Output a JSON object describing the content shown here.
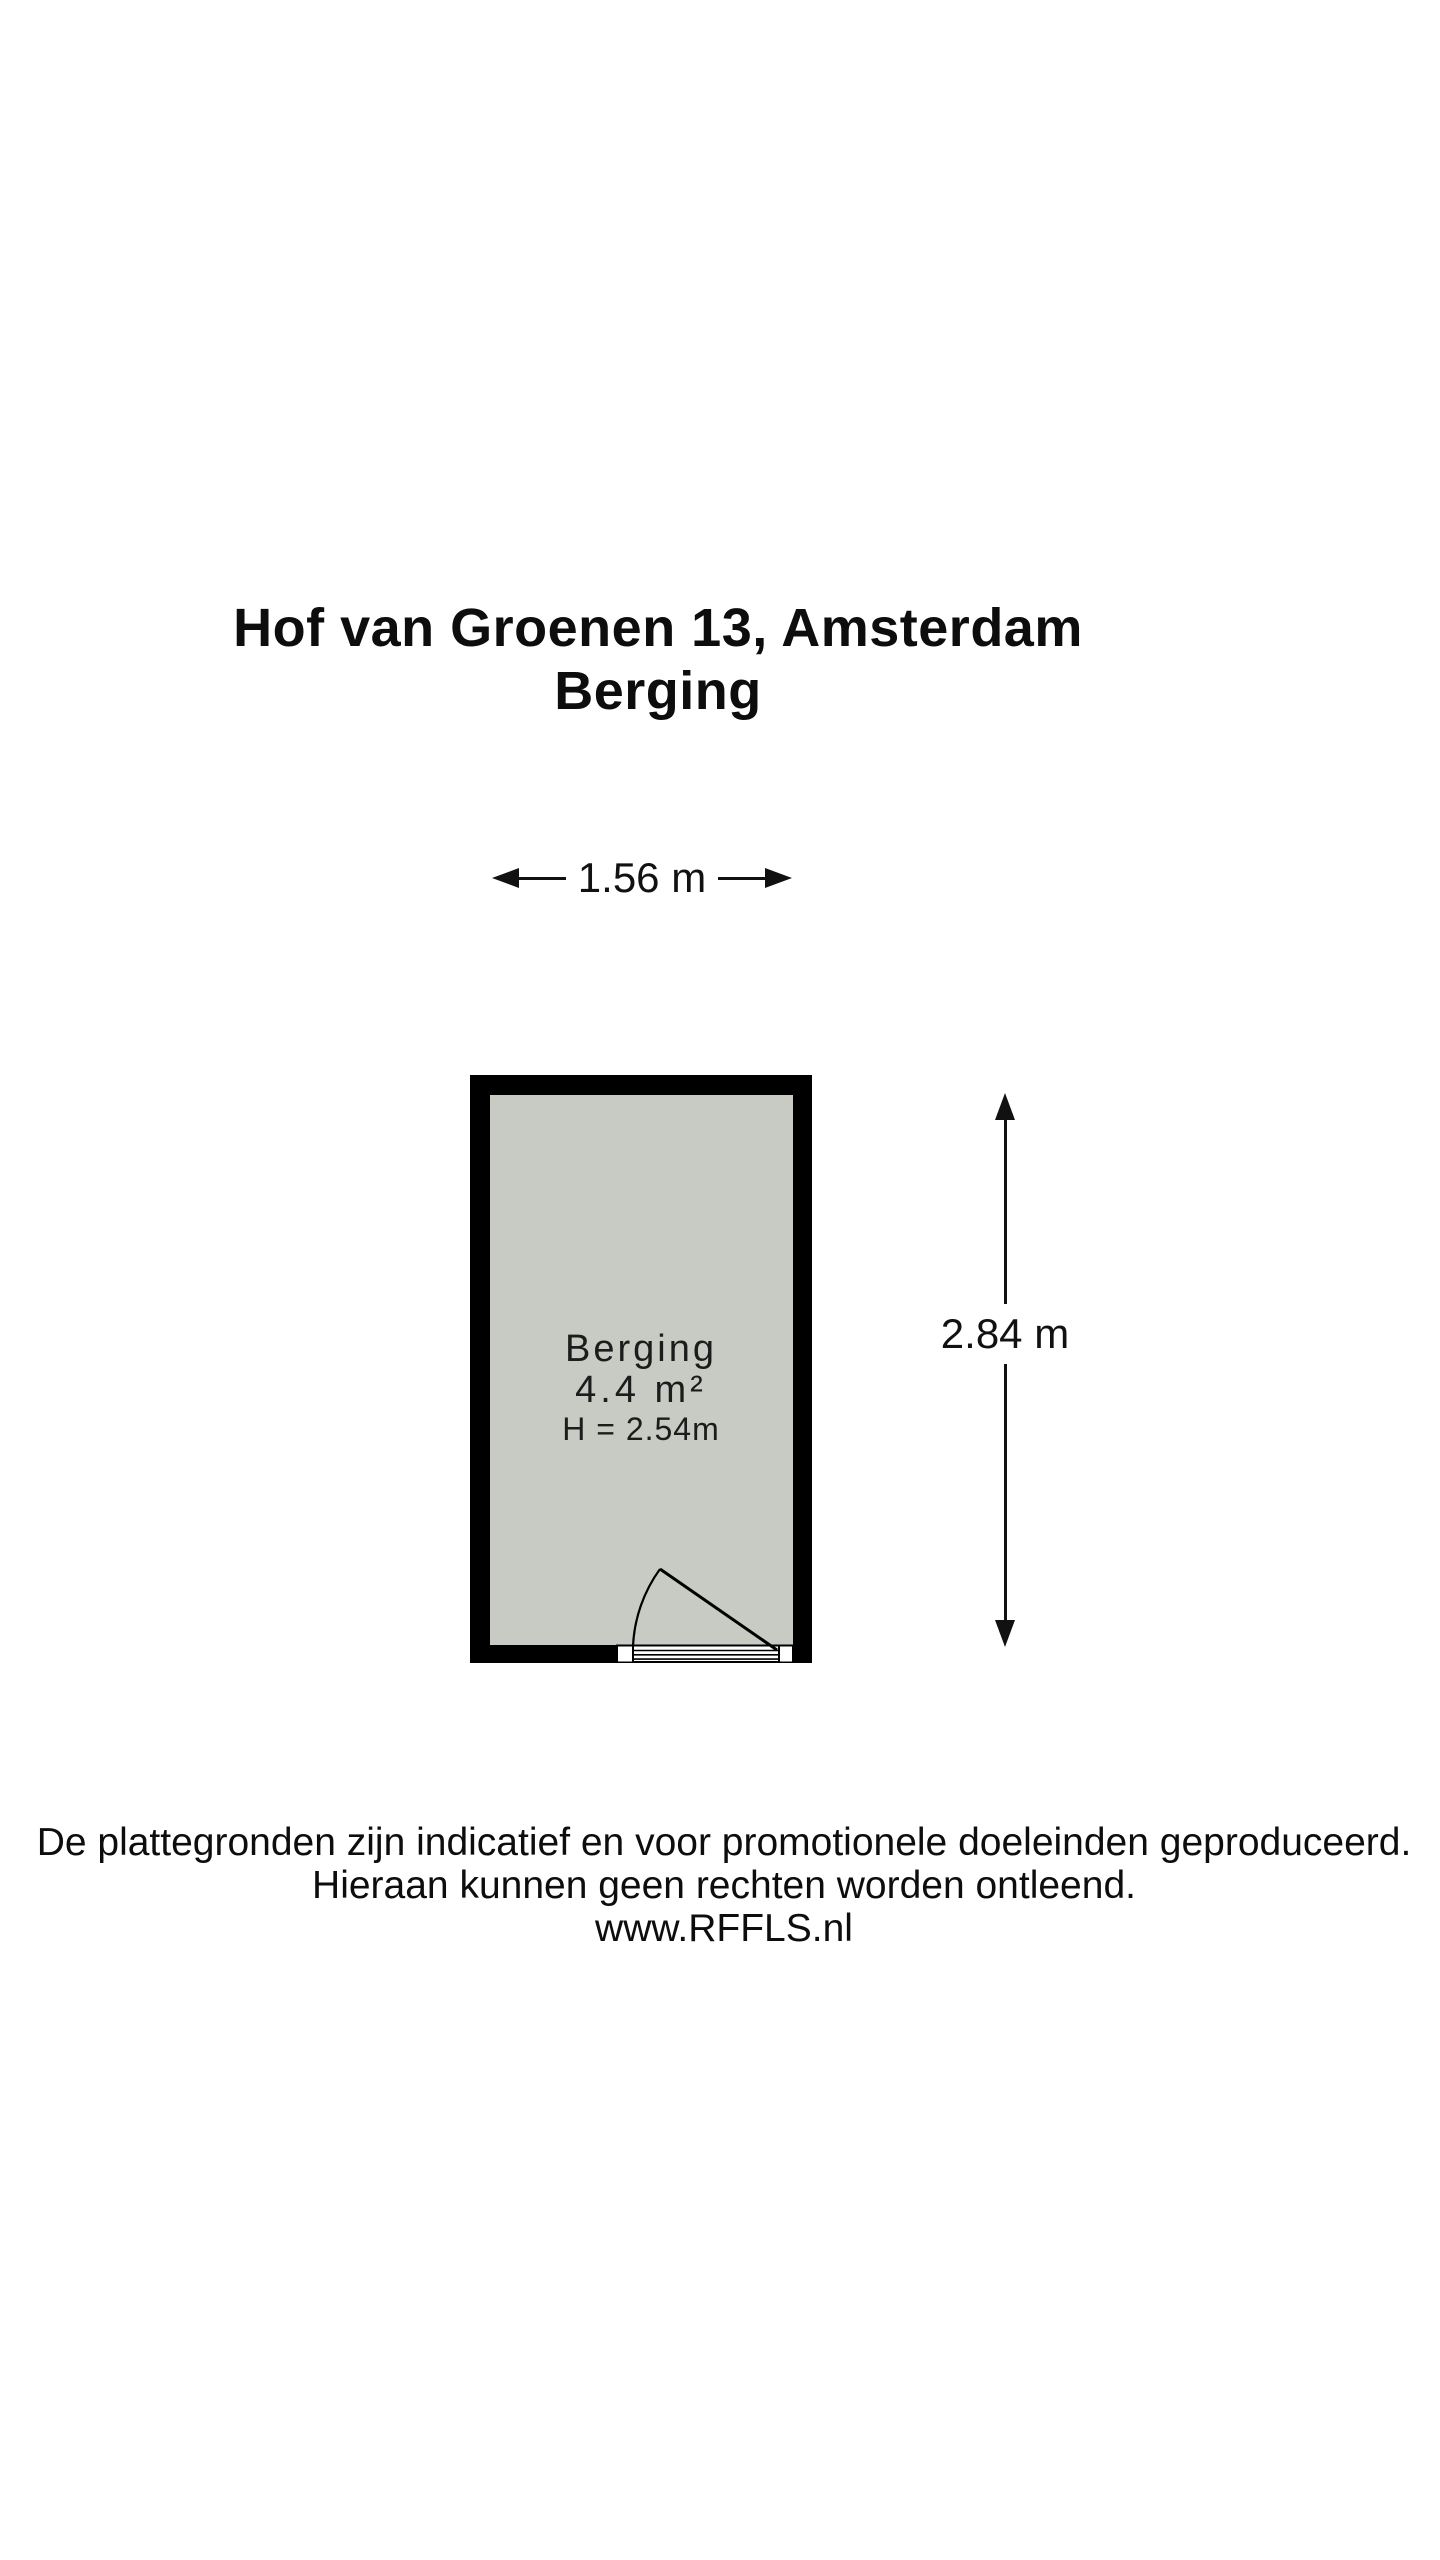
{
  "title": {
    "address": "Hof van Groenen 13, Amsterdam",
    "room": "Berging"
  },
  "dimensions": {
    "width": "1.56 m",
    "height": "2.84 m"
  },
  "room": {
    "name": "Berging",
    "area": "4.4 m²",
    "ceiling_height": "H = 2.54m"
  },
  "colors": {
    "wall": "#000000",
    "floor": "#c8cac4",
    "line": "#111111",
    "background": "#ffffff"
  },
  "disclaimer": {
    "line1": "De plattegronden zijn indicatief en voor promotionele doeleinden geproduceerd.",
    "line2": "Hieraan kunnen geen rechten worden ontleend.",
    "line3": "www.RFFLS.nl"
  }
}
